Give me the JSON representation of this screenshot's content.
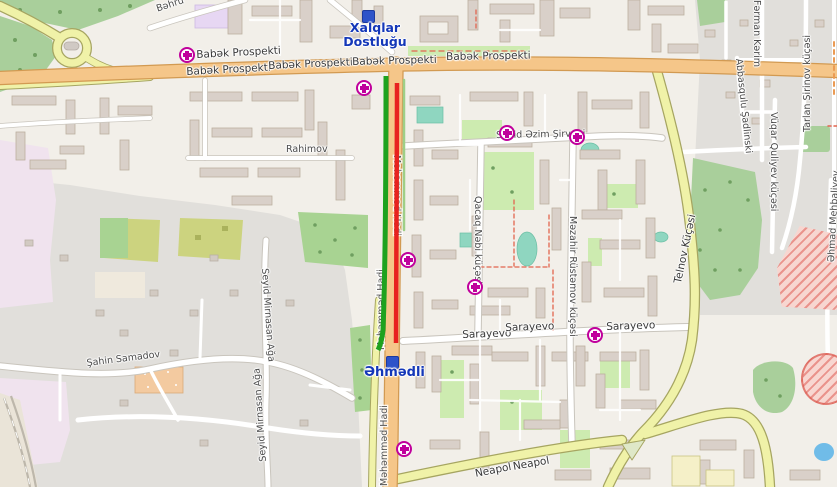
{
  "map": {
    "metro_stations": {
      "xalqlar_dostlugu": "Xalqlar Dostluğu",
      "ahmadli": "Əhmədli"
    },
    "street_labels": {
      "babak_prospekti": "Babək Prospekti",
      "bahruz": "Bəhru",
      "rahimov": "Rahimov",
      "seyid_azim_shirvani": "Seyid Əzim Şirvani",
      "qacaq_nabi": "Qacaq Nəbi küçəsi",
      "mazahir_rustamov": "Məzahir Rüstəmov küçəsi",
      "sarayevo": "Sarayevo",
      "neapol": "Neapol",
      "telnov": "Telnov Küçəsi",
      "mahammad_hadi": "Məhəmməd Hadi",
      "sahin_samadov": "Şahin Samadov",
      "seyid_mirnasan_aga": "Seyid Mirnasan Ağa",
      "farman_karim": "Fərman Kərim",
      "abbasqulu_shadlinski": "Abbasqulu Şadlinski",
      "tarlan_shirinov": "Tarlan Şirinov küçəsi",
      "vuqar_quliyev": "Vüqar Quliyev küçəsi",
      "ahmad_mehbaliyev": "Əhmad Mehbaliyev"
    },
    "icons": {
      "hospital": "magenta-cross-in-white-circle",
      "metro": "blue-rounded-square"
    },
    "route_overlay": {
      "green_line_color": "#1ea21e",
      "red_line_color": "#e8221f"
    },
    "palette": {
      "land": "#f2efe9",
      "residential_gray": "#e1dfdb",
      "retail_pink": "#f0e3ee",
      "park": "#a9cf9b",
      "grass": "#cdebb0",
      "primary_road": "#f5c689",
      "secondary_road": "#f0f2a8",
      "water": "#70bce8",
      "pitch": "#8fd6c0",
      "construction": "#e06060",
      "hospital_magenta": "#c0009c",
      "metro_blue": "#2e53c9"
    }
  }
}
